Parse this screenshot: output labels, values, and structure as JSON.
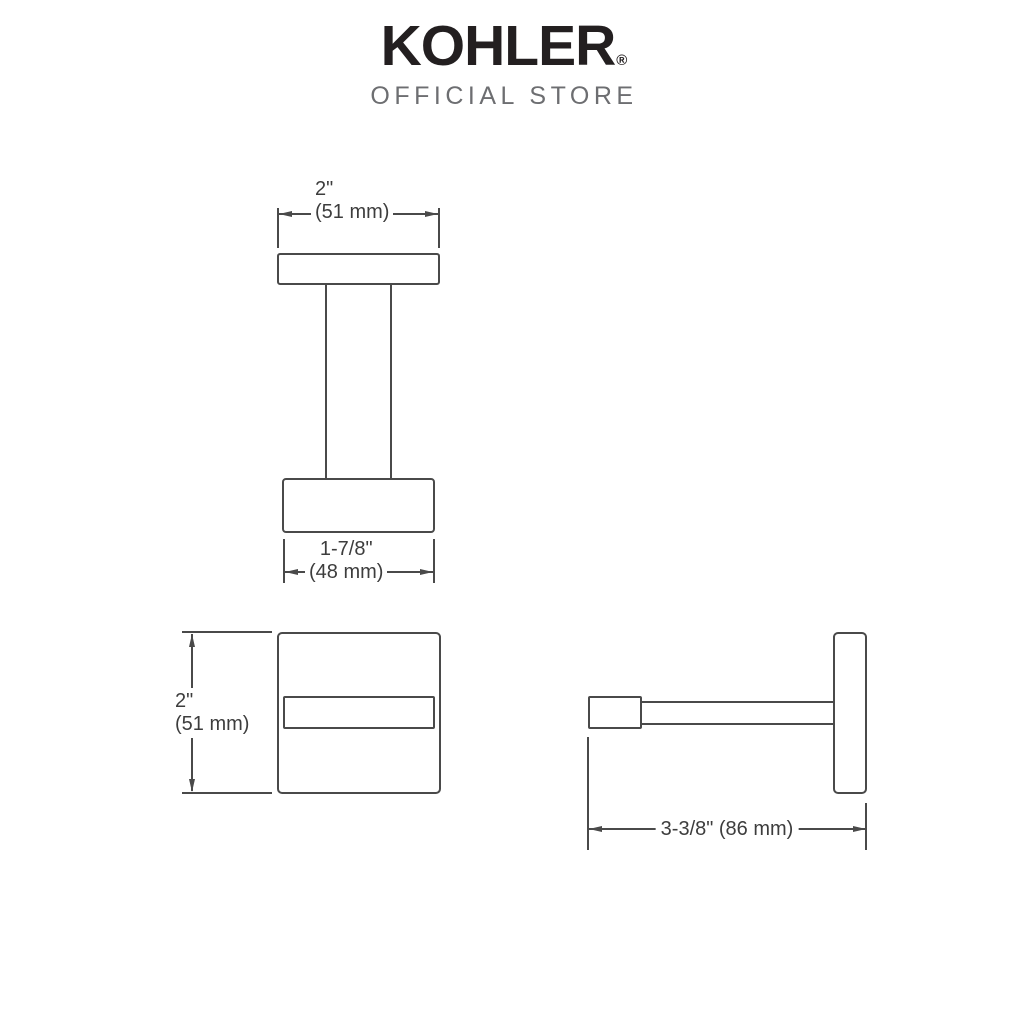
{
  "brand": {
    "logo_text": "KOHLER",
    "registered_mark": "®",
    "subtitle": "OFFICIAL STORE"
  },
  "colors": {
    "background": "#ffffff",
    "logo": "#231f20",
    "subtitle": "#6d6e71",
    "drawing_line": "#4a4a4a",
    "dimension_text": "#3d3d3d"
  },
  "views": {
    "top": {
      "dim_width_top": {
        "inches": "2\"",
        "mm": "(51 mm)"
      },
      "dim_width_bottom": {
        "inches": "1-7/8\"",
        "mm": "(48 mm)"
      }
    },
    "front": {
      "dim_height": {
        "inches": "2\"",
        "mm": "(51 mm)"
      }
    },
    "side": {
      "dim_depth": "3-3/8\" (86 mm)"
    }
  }
}
